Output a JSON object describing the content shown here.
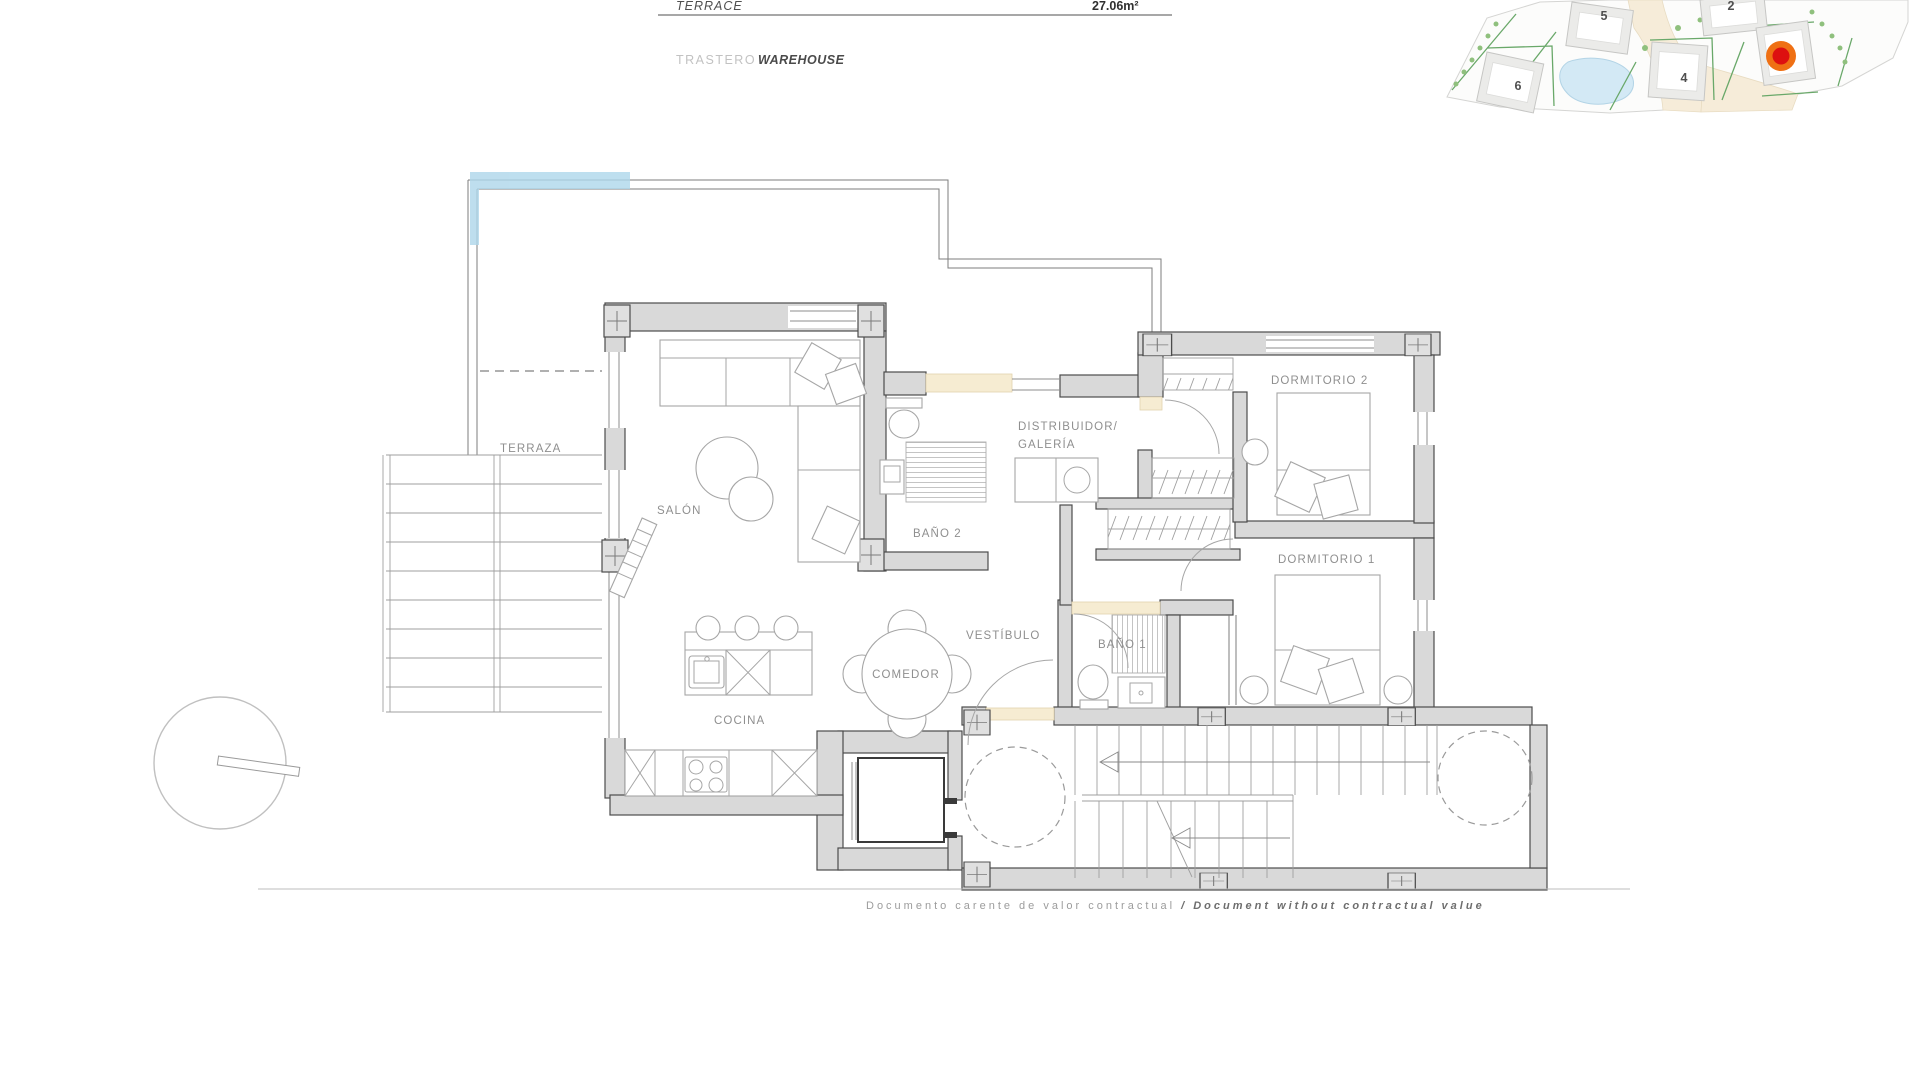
{
  "header": {
    "terrace_label": "TERRACE",
    "terrace_area": "27.06m²",
    "trastero_label": "TRASTERO",
    "warehouse_label": "WAREHOUSE"
  },
  "site_map": {
    "building_numbers": {
      "b2": "2",
      "b4": "4",
      "b5": "5",
      "b6": "6"
    },
    "marker_color_outer": "#ef7014",
    "marker_color_inner": "#dd1010",
    "pool_color": "#d3e9f5",
    "road_color": "#f6ecd9"
  },
  "floorplan": {
    "highlight_color": "#aed7eb",
    "labels": {
      "terraza": "TERRAZA",
      "salon": "SALÓN",
      "cocina": "COCINA",
      "comedor": "COMEDOR",
      "vestibulo": "VESTÍBULO",
      "bano1": "BAÑO 1",
      "bano2": "BAÑO 2",
      "distribuidor_line1": "DISTRIBUIDOR/",
      "distribuidor_line2": "GALERÍA",
      "dormitorio1": "DORMITORIO 1",
      "dormitorio2": "DORMITORIO 2"
    }
  },
  "footer": {
    "text_es": "Documento carente de valor contractual ",
    "text_en": "/ Document without contractual value"
  }
}
